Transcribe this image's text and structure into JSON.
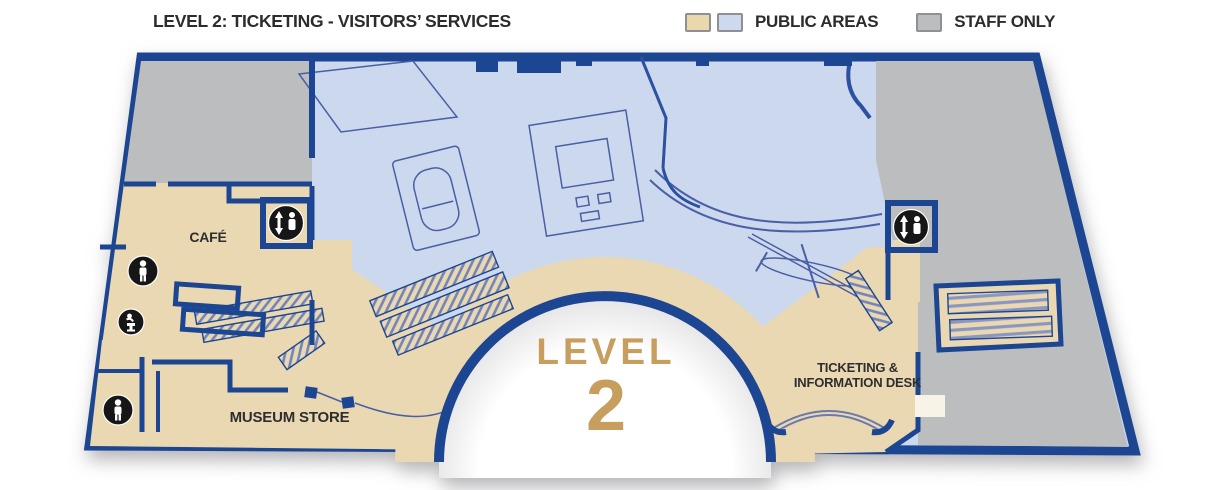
{
  "title": "LEVEL 2: TICKETING - VISITORS’ SERVICES",
  "legend": {
    "public": {
      "label": "PUBLIC AREAS",
      "swatch_colors": [
        "#e9d8ac",
        "#cdd9ee"
      ]
    },
    "staff": {
      "label": "STAFF ONLY",
      "swatch_color": "#bcbdbe"
    }
  },
  "map": {
    "level_word": "LEVEL",
    "level_number": "2",
    "rooms": {
      "cafe": {
        "label": "CAFÉ"
      },
      "museum_store": {
        "label": "MUSEUM STORE"
      },
      "ticketing": {
        "label_line1": "TICKETING &",
        "label_line2": "INFORMATION DESK"
      }
    },
    "icons": [
      {
        "name": "elevator-icon",
        "location": "cafe"
      },
      {
        "name": "elevator-icon",
        "location": "east-corridor"
      },
      {
        "name": "restroom-icon",
        "location": "west-upper"
      },
      {
        "name": "drinking-fountain-icon",
        "location": "west"
      },
      {
        "name": "restroom-icon",
        "location": "west-lower"
      }
    ],
    "colors": {
      "public_tan": "#e9d8b2",
      "public_blue": "#ccd8ee",
      "staff_gray": "#bcbdbe",
      "wall_blue": "#1c4592",
      "level_gold": "#c79e5e"
    }
  }
}
